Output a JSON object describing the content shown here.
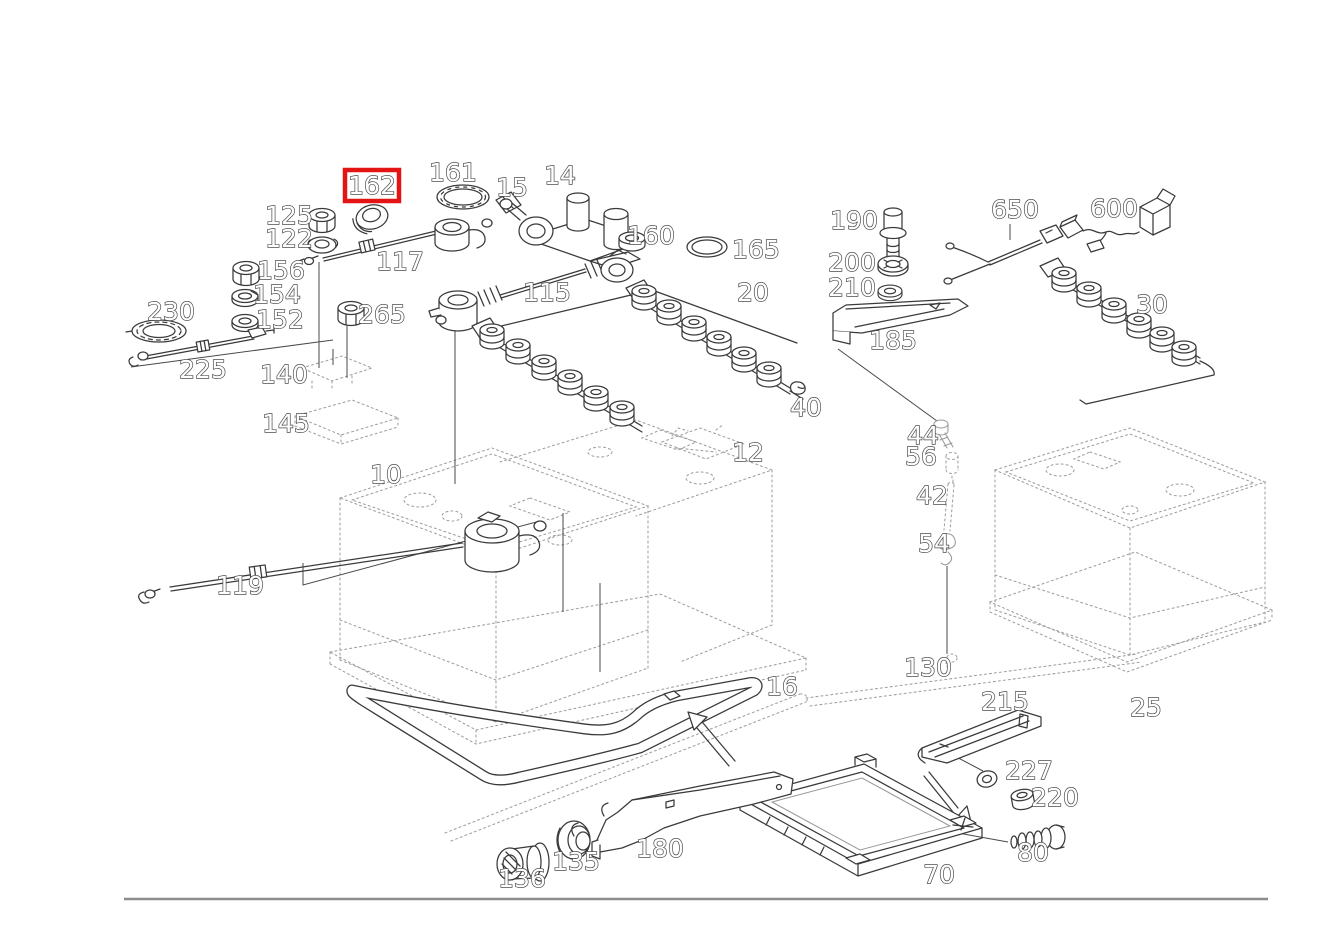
{
  "diagram": {
    "type": "exploded-parts-diagram",
    "subject": "battery and battery cable assembly",
    "background_color": "#ffffff",
    "line_color": "#3a3a3a",
    "reference_line_color": "#9f9f9f",
    "border_line_color": "#8d8d8d",
    "highlighted_part": "162",
    "highlight": {
      "color": "#e51414",
      "x": 345,
      "y": 170,
      "width": 54,
      "height": 31,
      "stroke_width": 4.5
    },
    "labels": [
      {
        "id": "162",
        "x": 372,
        "y": 194,
        "highlighted": true
      },
      {
        "id": "161",
        "x": 453,
        "y": 181
      },
      {
        "id": "15",
        "x": 512,
        "y": 196
      },
      {
        "id": "14",
        "x": 560,
        "y": 184
      },
      {
        "id": "125",
        "x": 289,
        "y": 224
      },
      {
        "id": "122",
        "x": 289,
        "y": 247
      },
      {
        "id": "156",
        "x": 281,
        "y": 279
      },
      {
        "id": "154",
        "x": 277,
        "y": 303
      },
      {
        "id": "152",
        "x": 280,
        "y": 328
      },
      {
        "id": "230",
        "x": 171,
        "y": 320
      },
      {
        "id": "225",
        "x": 203,
        "y": 378
      },
      {
        "id": "117",
        "x": 400,
        "y": 270
      },
      {
        "id": "265",
        "x": 382,
        "y": 323
      },
      {
        "id": "115",
        "x": 547,
        "y": 301
      },
      {
        "id": "160",
        "x": 651,
        "y": 244
      },
      {
        "id": "165",
        "x": 756,
        "y": 258
      },
      {
        "id": "20",
        "x": 753,
        "y": 301
      },
      {
        "id": "190",
        "x": 854,
        "y": 229
      },
      {
        "id": "200",
        "x": 852,
        "y": 271
      },
      {
        "id": "210",
        "x": 852,
        "y": 296
      },
      {
        "id": "185",
        "x": 893,
        "y": 349
      },
      {
        "id": "650",
        "x": 1015,
        "y": 218
      },
      {
        "id": "600",
        "x": 1114,
        "y": 217
      },
      {
        "id": "30",
        "x": 1152,
        "y": 313
      },
      {
        "id": "140",
        "x": 284,
        "y": 383
      },
      {
        "id": "145",
        "x": 286,
        "y": 432
      },
      {
        "id": "10",
        "x": 386,
        "y": 483
      },
      {
        "id": "12",
        "x": 748,
        "y": 461
      },
      {
        "id": "40",
        "x": 806,
        "y": 416
      },
      {
        "id": "44",
        "x": 923,
        "y": 444
      },
      {
        "id": "56",
        "x": 921,
        "y": 465
      },
      {
        "id": "42",
        "x": 932,
        "y": 504
      },
      {
        "id": "54",
        "x": 934,
        "y": 552
      },
      {
        "id": "130",
        "x": 928,
        "y": 676
      },
      {
        "id": "119",
        "x": 240,
        "y": 594
      },
      {
        "id": "16",
        "x": 782,
        "y": 695
      },
      {
        "id": "25",
        "x": 1146,
        "y": 716
      },
      {
        "id": "215",
        "x": 1005,
        "y": 710
      },
      {
        "id": "227",
        "x": 1029,
        "y": 779
      },
      {
        "id": "220",
        "x": 1055,
        "y": 806
      },
      {
        "id": "80",
        "x": 1033,
        "y": 861
      },
      {
        "id": "70",
        "x": 939,
        "y": 883
      },
      {
        "id": "136",
        "x": 522,
        "y": 887
      },
      {
        "id": "135",
        "x": 576,
        "y": 870
      },
      {
        "id": "180",
        "x": 660,
        "y": 857
      }
    ]
  }
}
